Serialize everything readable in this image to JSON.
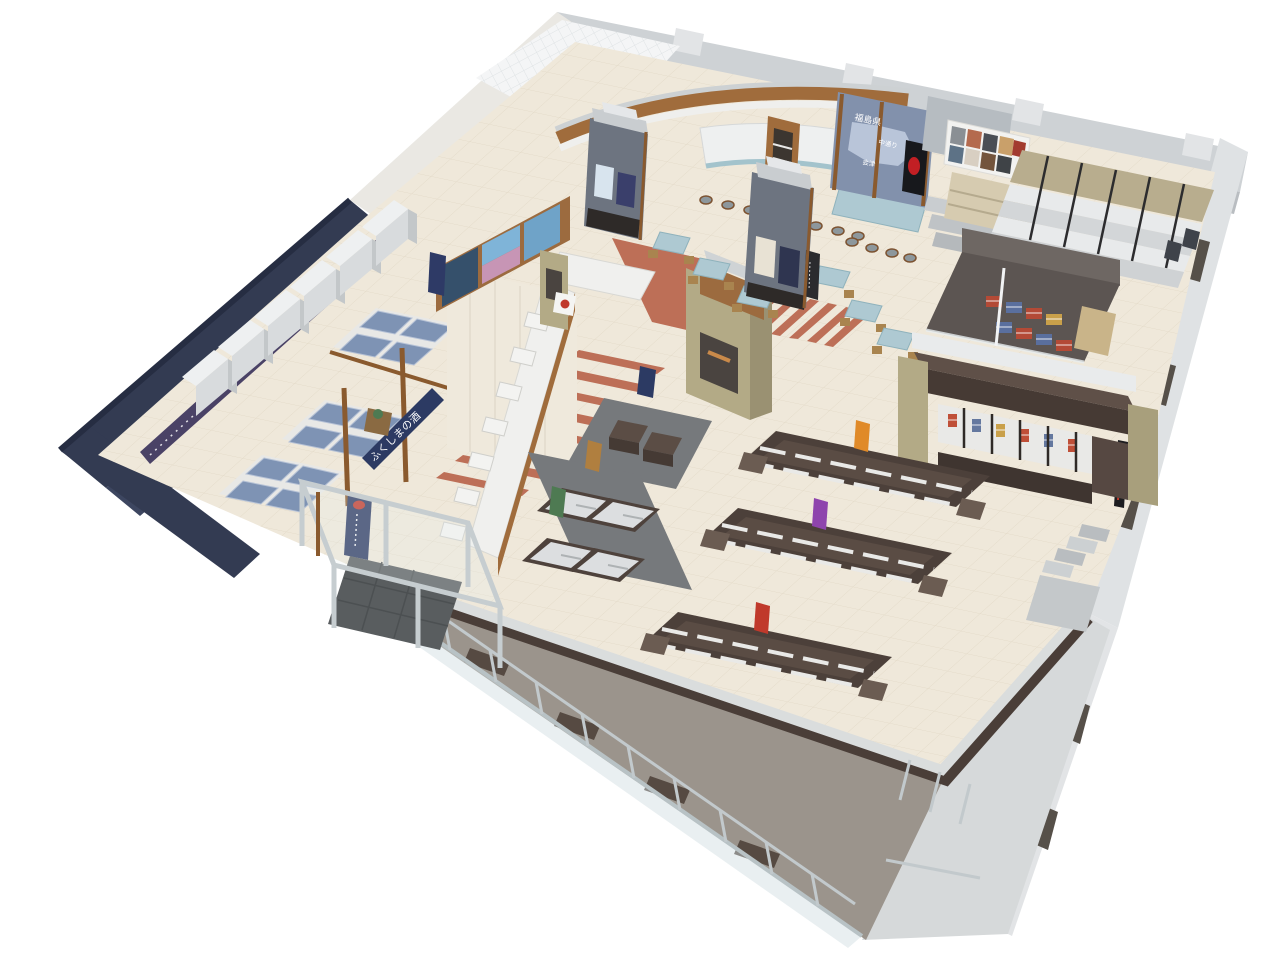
{
  "scene": {
    "description": "3D isometric cutaway rendering of a retail store floor plan (Fukushima antenna shop) with tasting counter and dining area, sake corner, gondola shelving, chiller cases, souvenir kiosk, craft room and glass facade",
    "background_color": "#ffffff"
  },
  "texts": {
    "prefecture_label": "福島県",
    "region_label_1": "中通り",
    "region_label_2": "会津",
    "sake_area_sign": "ふくしまの酒"
  },
  "palette": {
    "wall_gray": "#ced2d5",
    "wall_gray_inner": "#b9bdc1",
    "wall_white": "#eae8e3",
    "navy_wall": "#333b52",
    "navy_wall_dark": "#262d42",
    "floor_beige": "#efe8da",
    "tile_line": "#e3dac8",
    "terracotta": "#bd6f57",
    "mat_gray": "#76797c",
    "gondola_brown": "#4c403a",
    "shelf_white": "#e9e9e7",
    "product_blue": "#7e93b4",
    "wood": "#a06c3c",
    "khaki": "#b3aa86",
    "tower_gray": "#6d7480",
    "counter_blue": "#a3c3cc",
    "map_panel_blue": "#8291ac",
    "banner_purple": "#4a4266",
    "sign_navy": "#2c3a63",
    "sign_red": "#c0392b",
    "sign_green": "#4e7a52",
    "sign_tan": "#b07f3f",
    "sign_orange": "#e08a28",
    "sign_purple": "#8e44ad",
    "glass": "#cfdce0"
  },
  "fixtures": [
    "dining-counter-with-stools",
    "dining-tables",
    "pillar-display-towers",
    "fukushima-map-wall",
    "photo-collage-board",
    "tiered-wall-display",
    "craft-goods-room",
    "souvenir-kiosk",
    "sake-wall-fridges",
    "sake-island-gondolas",
    "hanging-sake-sign",
    "photo-mural-wall",
    "stepped-display-counter",
    "chiller-cases",
    "long-gondola-shelves",
    "entrance-vestibule",
    "glass-curtain-wall",
    "exterior-walkway"
  ]
}
